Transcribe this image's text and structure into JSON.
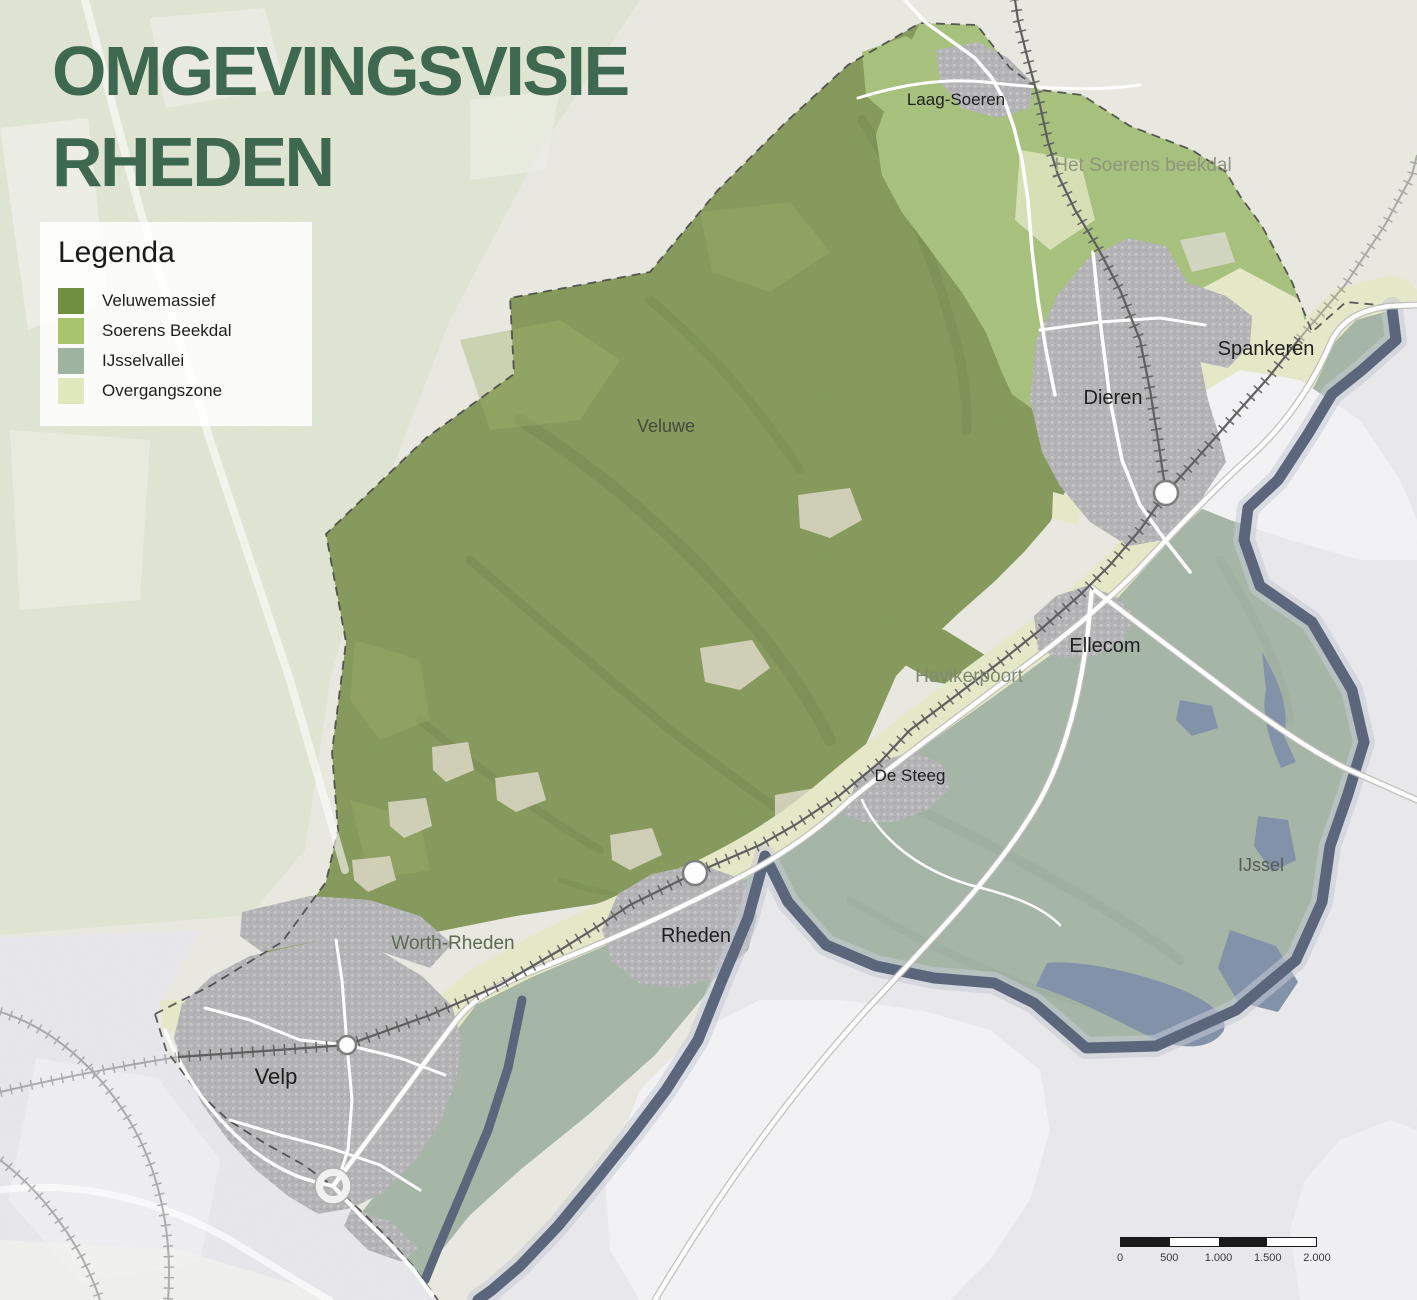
{
  "title": {
    "line1": "OMGEVINGSVISIE",
    "line2": "RHEDEN"
  },
  "legend": {
    "heading": "Legenda",
    "items": [
      {
        "id": "veluwemassief",
        "label": "Veluwemassief",
        "color": "#70903f"
      },
      {
        "id": "soerens-beekdal",
        "label": "Soerens Beekdal",
        "color": "#a8c46c"
      },
      {
        "id": "ijsselvallei",
        "label": "IJsselvallei",
        "color": "#9eb4a1"
      },
      {
        "id": "overgangszone",
        "label": "Overgangszone",
        "color": "#dfe9bb"
      }
    ]
  },
  "map": {
    "labels": [
      {
        "id": "laag-soeren",
        "text": "Laag-Soeren",
        "x": 956,
        "y": 105,
        "size": 17,
        "color": "#1f1f1f"
      },
      {
        "id": "soerens-beekdal",
        "text": "Het Soerens beekdal",
        "x": 1143,
        "y": 171,
        "size": 19,
        "color": "#8f957d"
      },
      {
        "id": "spankeren",
        "text": "Spankeren",
        "x": 1266,
        "y": 355,
        "size": 20,
        "color": "#1f1f1f"
      },
      {
        "id": "dieren",
        "text": "Dieren",
        "x": 1113,
        "y": 404,
        "size": 20,
        "color": "#1f1f1f"
      },
      {
        "id": "veluwe",
        "text": "Veluwe",
        "x": 666,
        "y": 432,
        "size": 18,
        "color": "#454a3c"
      },
      {
        "id": "ellecom",
        "text": "Ellecom",
        "x": 1105,
        "y": 652,
        "size": 20,
        "color": "#1f1f1f"
      },
      {
        "id": "havikerpoort",
        "text": "Havikerpoort",
        "x": 969,
        "y": 682,
        "size": 19,
        "color": "#7e8a70"
      },
      {
        "id": "de-steeg",
        "text": "De Steeg",
        "x": 910,
        "y": 781,
        "size": 17,
        "color": "#1f1f1f"
      },
      {
        "id": "ijssel",
        "text": "IJssel",
        "x": 1261,
        "y": 871,
        "size": 18,
        "color": "#575c50"
      },
      {
        "id": "rheden",
        "text": "Rheden",
        "x": 696,
        "y": 942,
        "size": 20,
        "color": "#1f1f1f"
      },
      {
        "id": "worth-rheden",
        "text": "Worth-Rheden",
        "x": 453,
        "y": 949,
        "size": 19,
        "color": "#5e6a54"
      },
      {
        "id": "velp",
        "text": "Velp",
        "x": 276,
        "y": 1084,
        "size": 22,
        "color": "#1f1f1f"
      }
    ]
  },
  "scalebar": {
    "ticks": [
      "0",
      "500",
      "1.000",
      "1.500",
      "2.000"
    ],
    "segment_fills": [
      "#1a1a1a",
      "#ffffff",
      "#1a1a1a",
      "#ffffff"
    ]
  },
  "colors": {
    "page_bg": "#e9e9e1",
    "title": "#3e6950",
    "nw_tint": "#dce2cd",
    "massif": "#85995b",
    "massif_shade": "#64783f",
    "beekdal": "#a7c17c",
    "valley": "#a5b5a6",
    "overgang": "#e6e9c8",
    "urban": "#b4b4b6",
    "urban_dot": "#c7c7c9",
    "river": "#59647a",
    "river_halo": "#c6cad6",
    "water": "#8191a9",
    "outside_east": "#e9e9ec",
    "white_patch": "#f3f3f5",
    "clearing": "#d8d5c0",
    "road": "#ffffff",
    "road_casing": "#bdbdb8",
    "rail": "#5d5d5d",
    "boundary": "#3f3f3f"
  }
}
